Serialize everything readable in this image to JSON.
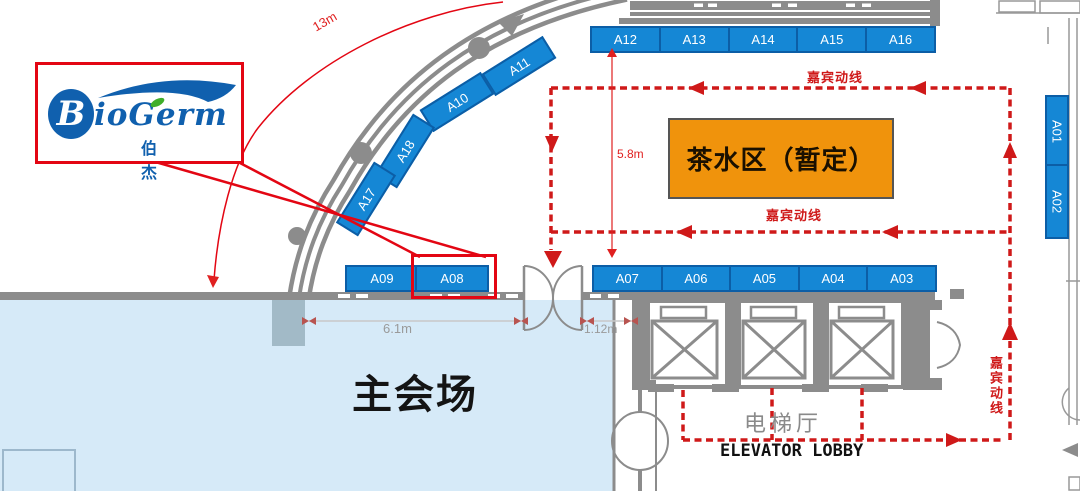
{
  "logo": {
    "mark": "B",
    "name": "ioGerm",
    "cn": "伯杰"
  },
  "areas": {
    "main_hall": "主会场",
    "tea": "茶水区（暂定）",
    "elevator_cn": "电梯厅",
    "elevator_en": "ELEVATOR LOBBY"
  },
  "flow": {
    "label": "嘉宾动线"
  },
  "dims": {
    "arc_length": "13m",
    "row_gap": "5.8m",
    "hall_width": "6.1m",
    "door_offset": "1.12m"
  },
  "booths": {
    "top": [
      "A12",
      "A13",
      "A14",
      "A15",
      "A16"
    ],
    "mid_left": [
      "A09",
      "A08"
    ],
    "mid_right": [
      "A07",
      "A06",
      "A05",
      "A04",
      "A03"
    ],
    "right_col": [
      "A01",
      "A02"
    ],
    "arc": [
      "A11",
      "A10",
      "A18",
      "A17"
    ]
  },
  "colors": {
    "booth_blue": "#1587d5",
    "booth_border": "#0c5ea6",
    "hall_blue": "#d6eaf8",
    "tea_orange": "#f0930c",
    "wall_gray": "#8c8c8c",
    "route_red": "#cf1919",
    "highlight_red": "#e30613"
  }
}
